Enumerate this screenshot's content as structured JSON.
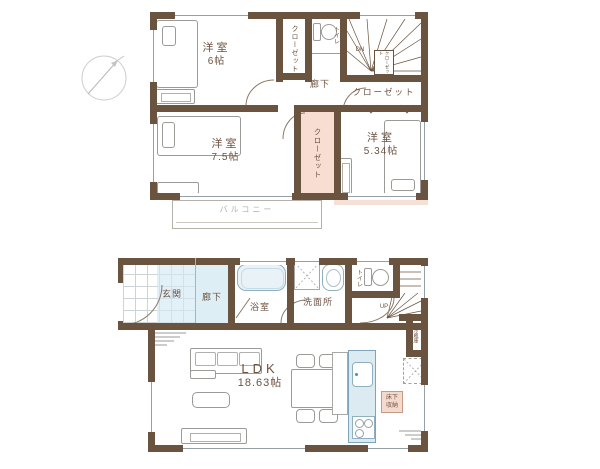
{
  "colors": {
    "wall": "#6a5440",
    "label": "#6b5341",
    "closet_fill": "#f8ded2",
    "fixture_fill": "#e9f3f7",
    "fixture_line": "#8fb0c0",
    "hall_floor": "#ddeef5"
  },
  "floor2": {
    "room_6": {
      "name": "洋室",
      "size": "6帖"
    },
    "room_7_5": {
      "name": "洋室",
      "size": "7.5帖"
    },
    "room_5_34": {
      "name": "洋室",
      "size": "5.34帖"
    },
    "closet_left": {
      "label": "クローゼット"
    },
    "closet_middle": {
      "label": "クローゼット"
    },
    "closet_top_right": {
      "label": "クローゼット"
    },
    "closet_stairs": {
      "label": "クローゼット"
    },
    "toilet": {
      "label": "トイレ"
    },
    "hallway": {
      "label": "廊下"
    },
    "stairs": {
      "label": "DN"
    },
    "balcony": {
      "label": "バルコニー"
    }
  },
  "floor1": {
    "entrance": {
      "label": "玄関"
    },
    "hallway": {
      "label": "廊下"
    },
    "bathroom": {
      "label": "浴室"
    },
    "washroom": {
      "label": "洗面所"
    },
    "toilet": {
      "label": "トイレ"
    },
    "stairs": {
      "label": "UP"
    },
    "refrigerator": {
      "label": "冷蔵庫"
    },
    "ldk": {
      "name": "LDK",
      "size": "18.63帖"
    },
    "underfloor_storage": {
      "line1": "床下",
      "line2": "収納"
    }
  }
}
